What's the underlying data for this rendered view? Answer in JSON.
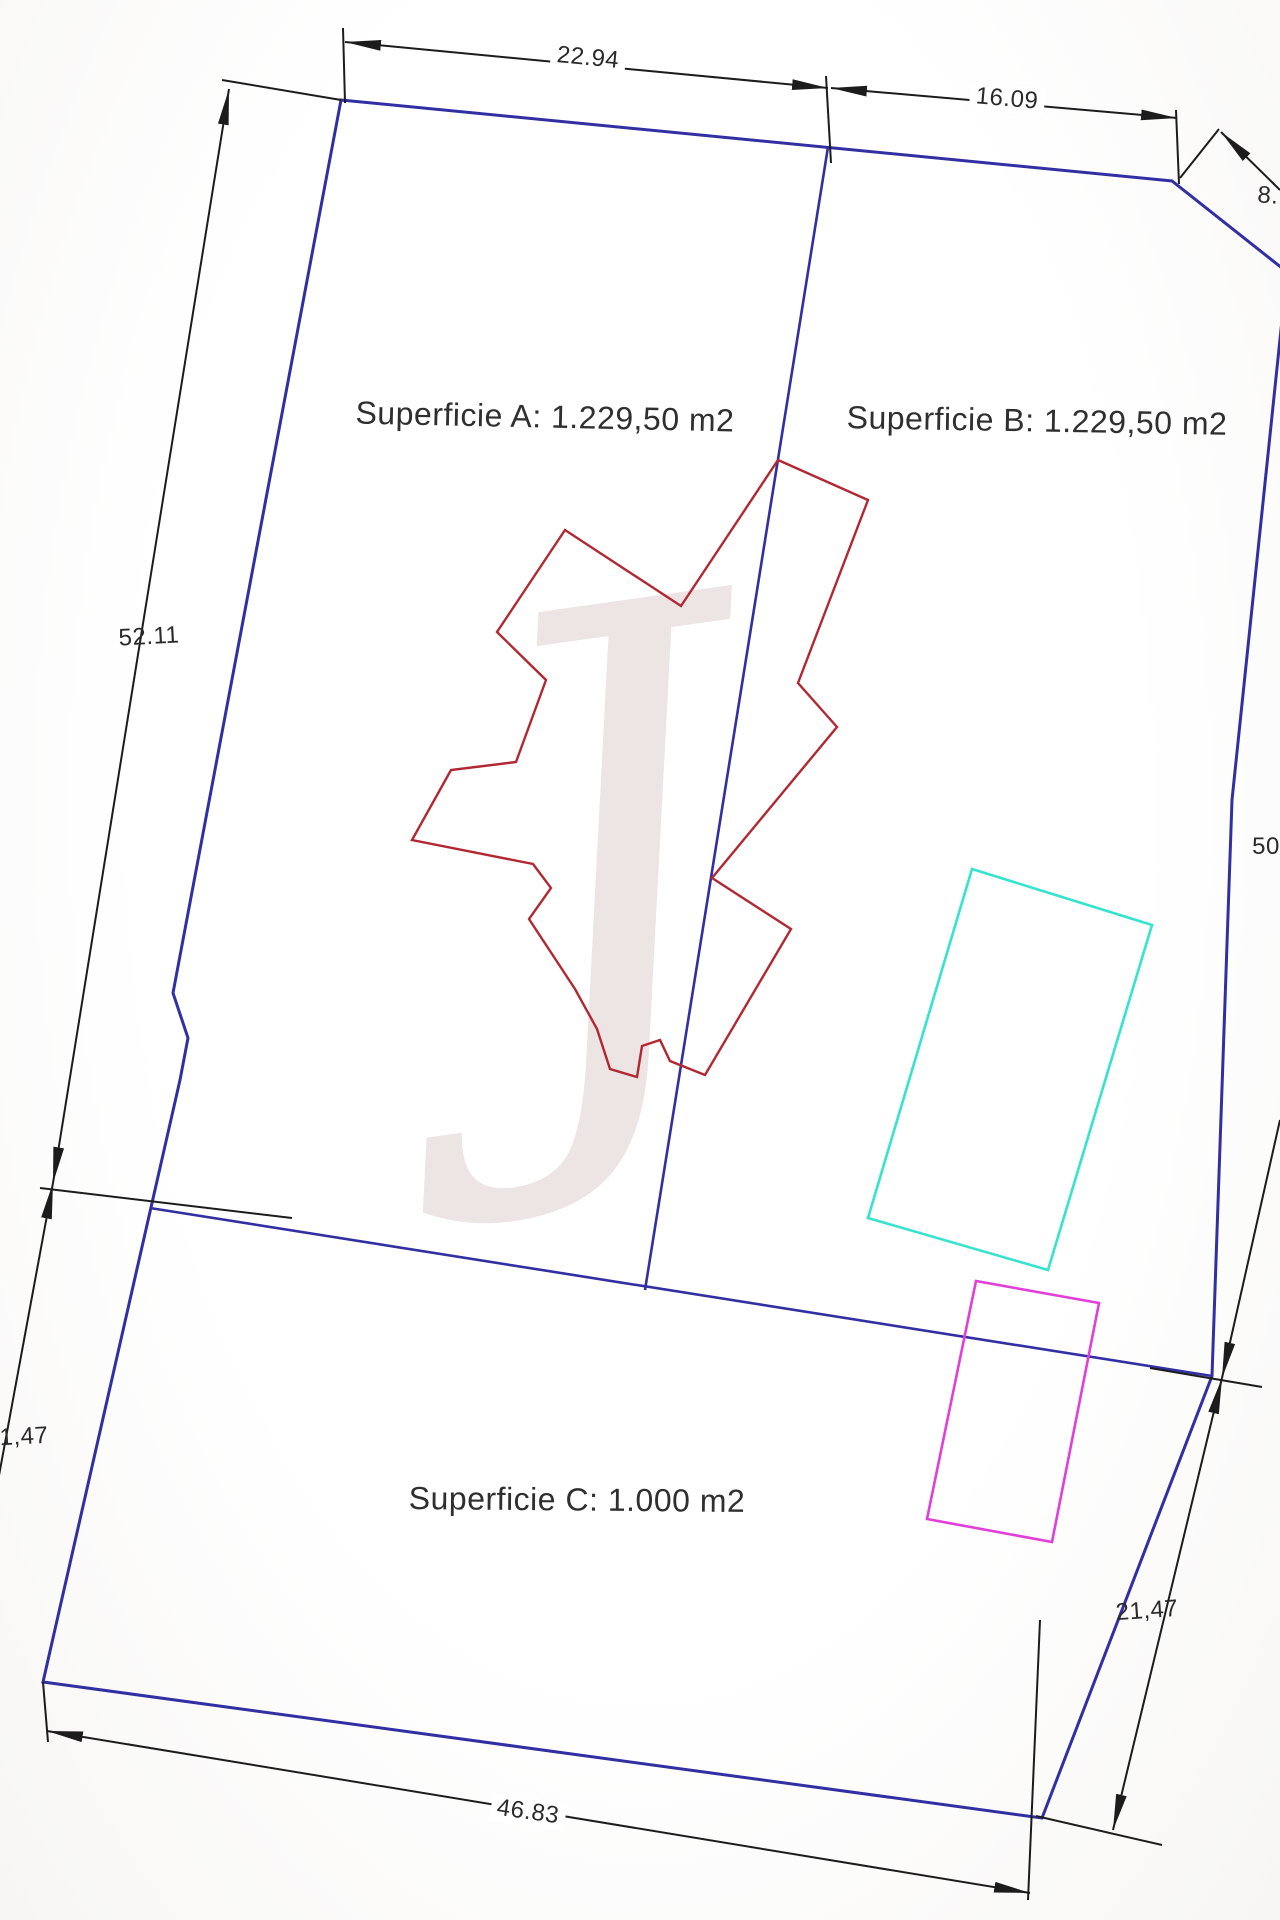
{
  "plan": {
    "kind": "land-survey-plan",
    "canvas": {
      "width": 1280,
      "height": 1920
    }
  },
  "labels": {
    "superficie_a": "Superficie A: 1.229,50 m2",
    "superficie_b": "Superficie B: 1.229,50 m2",
    "superficie_c": "Superficie C: 1.000 m2"
  },
  "area_label_style": {
    "color": "#2f2f2f"
  },
  "watermark": {
    "glyph": "J",
    "color": "rgba(200,172,172,0.33)"
  },
  "colors": {
    "boundary_blue": "#312fa2",
    "building_red": "#b22832",
    "pool_cyan": "#35e3cf",
    "rect_magenta": "#e03fd8",
    "dimension_black": "#1c1c1c",
    "dim_text": "#2a2a2a"
  },
  "dimensions": [
    {
      "name": "dim-22.94",
      "text": "22.94",
      "x": 588,
      "y": 58,
      "rot": 5.5,
      "halo": true
    },
    {
      "name": "dim-16.09",
      "text": "16.09",
      "x": 1007,
      "y": 99,
      "rot": 5,
      "halo": true
    },
    {
      "name": "dim-8",
      "text": "8.",
      "x": 1268,
      "y": 196,
      "rot": 4,
      "halo": false
    },
    {
      "name": "dim-52.11",
      "text": "52.11",
      "x": 149,
      "y": 637,
      "rot": -3,
      "halo": false
    },
    {
      "name": "dim-50",
      "text": "50",
      "x": 1266,
      "y": 847,
      "rot": 0,
      "halo": false
    },
    {
      "name": "dim-1,47",
      "text": "1,47",
      "x": 24,
      "y": 1437,
      "rot": -3,
      "halo": false
    },
    {
      "name": "dim-21,47",
      "text": "21,47",
      "x": 1147,
      "y": 1611,
      "rot": -4,
      "halo": false
    },
    {
      "name": "dim-46.83",
      "text": "46.83",
      "x": 528,
      "y": 1812,
      "rot": 8,
      "halo": true
    }
  ],
  "geometry": {
    "shapes": [
      {
        "name": "parcel-boundary",
        "kind": "polygon",
        "stroke": "#312fa2",
        "width": 3,
        "points": "341,100 1172,181 1287,272 1232,800 1212,1376 1042,1818 43,1682 180,1080 188,1038 173,993"
      },
      {
        "name": "divider-a-b",
        "kind": "line",
        "stroke": "#312fa2",
        "width": 2.6,
        "x1": 828,
        "y1": 147,
        "x2": 645,
        "y2": 1290
      },
      {
        "name": "divider-b-c",
        "kind": "line",
        "stroke": "#312fa2",
        "width": 2.6,
        "x1": 150,
        "y1": 1208,
        "x2": 1212,
        "y2": 1376
      },
      {
        "name": "building-footprint",
        "kind": "polygon",
        "stroke": "#b22832",
        "width": 2.4,
        "points": "778,460 868,500 798,683 837,727 712,878 791,929 705,1075 670,1061 660,1040 642,1046 637,1077 610,1069 597,1029 575,989 529,919 551,888 533,864 412,840 451,770 516,762 546,680 497,632 565,530 681,606"
      },
      {
        "name": "pool-rectangle",
        "kind": "polygon",
        "stroke": "#35e3cf",
        "width": 2.6,
        "points": "972,869 1152,925 1048,1270 868,1218"
      },
      {
        "name": "magenta-rectangle",
        "kind": "polygon",
        "stroke": "#e03fd8",
        "width": 2.6,
        "points": "976,1281 1099,1303 1052,1542 927,1519"
      },
      {
        "name": "ext-top-left-corner",
        "kind": "line",
        "stroke": "#1c1c1c",
        "width": 2,
        "x1": 343,
        "y1": 28,
        "x2": 345,
        "y2": 103
      },
      {
        "name": "ext-divider-top",
        "kind": "line",
        "stroke": "#1c1c1c",
        "width": 2,
        "x1": 826,
        "y1": 76,
        "x2": 831,
        "y2": 163
      },
      {
        "name": "ext-chamfer-top",
        "kind": "line",
        "stroke": "#1c1c1c",
        "width": 2,
        "x1": 1176,
        "y1": 110,
        "x2": 1179,
        "y2": 184
      },
      {
        "name": "ext-chamfer-corner",
        "kind": "line",
        "stroke": "#1c1c1c",
        "width": 2,
        "x1": 1180,
        "y1": 178,
        "x2": 1219,
        "y2": 129
      },
      {
        "name": "dim-line-8",
        "kind": "line",
        "stroke": "#1c1c1c",
        "width": 2,
        "x1": 1221,
        "y1": 132,
        "x2": 1280,
        "y2": 190,
        "arrowStart": true
      },
      {
        "name": "dim-line-22.94",
        "kind": "line",
        "stroke": "#1c1c1c",
        "width": 2,
        "x1": 345,
        "y1": 42,
        "x2": 828,
        "y2": 88,
        "arrowStart": true,
        "arrowEnd": true
      },
      {
        "name": "dim-line-16.09",
        "kind": "line",
        "stroke": "#1c1c1c",
        "width": 2,
        "x1": 831,
        "y1": 88,
        "x2": 1177,
        "y2": 118,
        "arrowStart": true,
        "arrowEnd": true
      },
      {
        "name": "ext-52.11-top",
        "kind": "line",
        "stroke": "#1c1c1c",
        "width": 2,
        "x1": 341,
        "y1": 100,
        "x2": 222,
        "y2": 80
      },
      {
        "name": "dim-line-52.11",
        "kind": "line",
        "stroke": "#1c1c1c",
        "width": 2,
        "x1": 229,
        "y1": 89,
        "x2": 53,
        "y2": 1183,
        "arrowStart": true,
        "arrowEnd": true
      },
      {
        "name": "ext-left-junction",
        "kind": "line",
        "stroke": "#1c1c1c",
        "width": 2,
        "x1": 40,
        "y1": 1188,
        "x2": 292,
        "y2": 1218
      },
      {
        "name": "dim-line-1,47",
        "kind": "line",
        "stroke": "#1c1c1c",
        "width": 2,
        "x1": 53,
        "y1": 1183,
        "x2": -12,
        "y2": 1535,
        "arrowStart": true
      },
      {
        "name": "ext-bottom-left",
        "kind": "line",
        "stroke": "#1c1c1c",
        "width": 2,
        "x1": 43,
        "y1": 1682,
        "x2": 48,
        "y2": 1742
      },
      {
        "name": "dim-line-46.83",
        "kind": "line",
        "stroke": "#1c1c1c",
        "width": 2,
        "x1": 47,
        "y1": 1731,
        "x2": 1030,
        "y2": 1893,
        "arrowStart": true,
        "arrowEnd": true
      },
      {
        "name": "ext-bottom-right-vertical",
        "kind": "line",
        "stroke": "#1c1c1c",
        "width": 2,
        "x1": 1040,
        "y1": 1620,
        "x2": 1028,
        "y2": 1900
      },
      {
        "name": "ext-bottom-right-horizontal",
        "kind": "line",
        "stroke": "#1c1c1c",
        "width": 2,
        "x1": 1036,
        "y1": 1816,
        "x2": 1162,
        "y2": 1845
      },
      {
        "name": "dim-line-50",
        "kind": "line",
        "stroke": "#1c1c1c",
        "width": 2,
        "x1": 1280,
        "y1": 1120,
        "x2": 1222,
        "y2": 1378,
        "arrowEnd": true
      },
      {
        "name": "dim-line-21,47",
        "kind": "line",
        "stroke": "#1c1c1c",
        "width": 2,
        "x1": 1222,
        "y1": 1378,
        "x2": 1113,
        "y2": 1830,
        "arrowStart": true,
        "arrowEnd": true
      },
      {
        "name": "ext-divider-right",
        "kind": "line",
        "stroke": "#1c1c1c",
        "width": 2,
        "x1": 1150,
        "y1": 1368,
        "x2": 1262,
        "y2": 1387
      }
    ]
  }
}
